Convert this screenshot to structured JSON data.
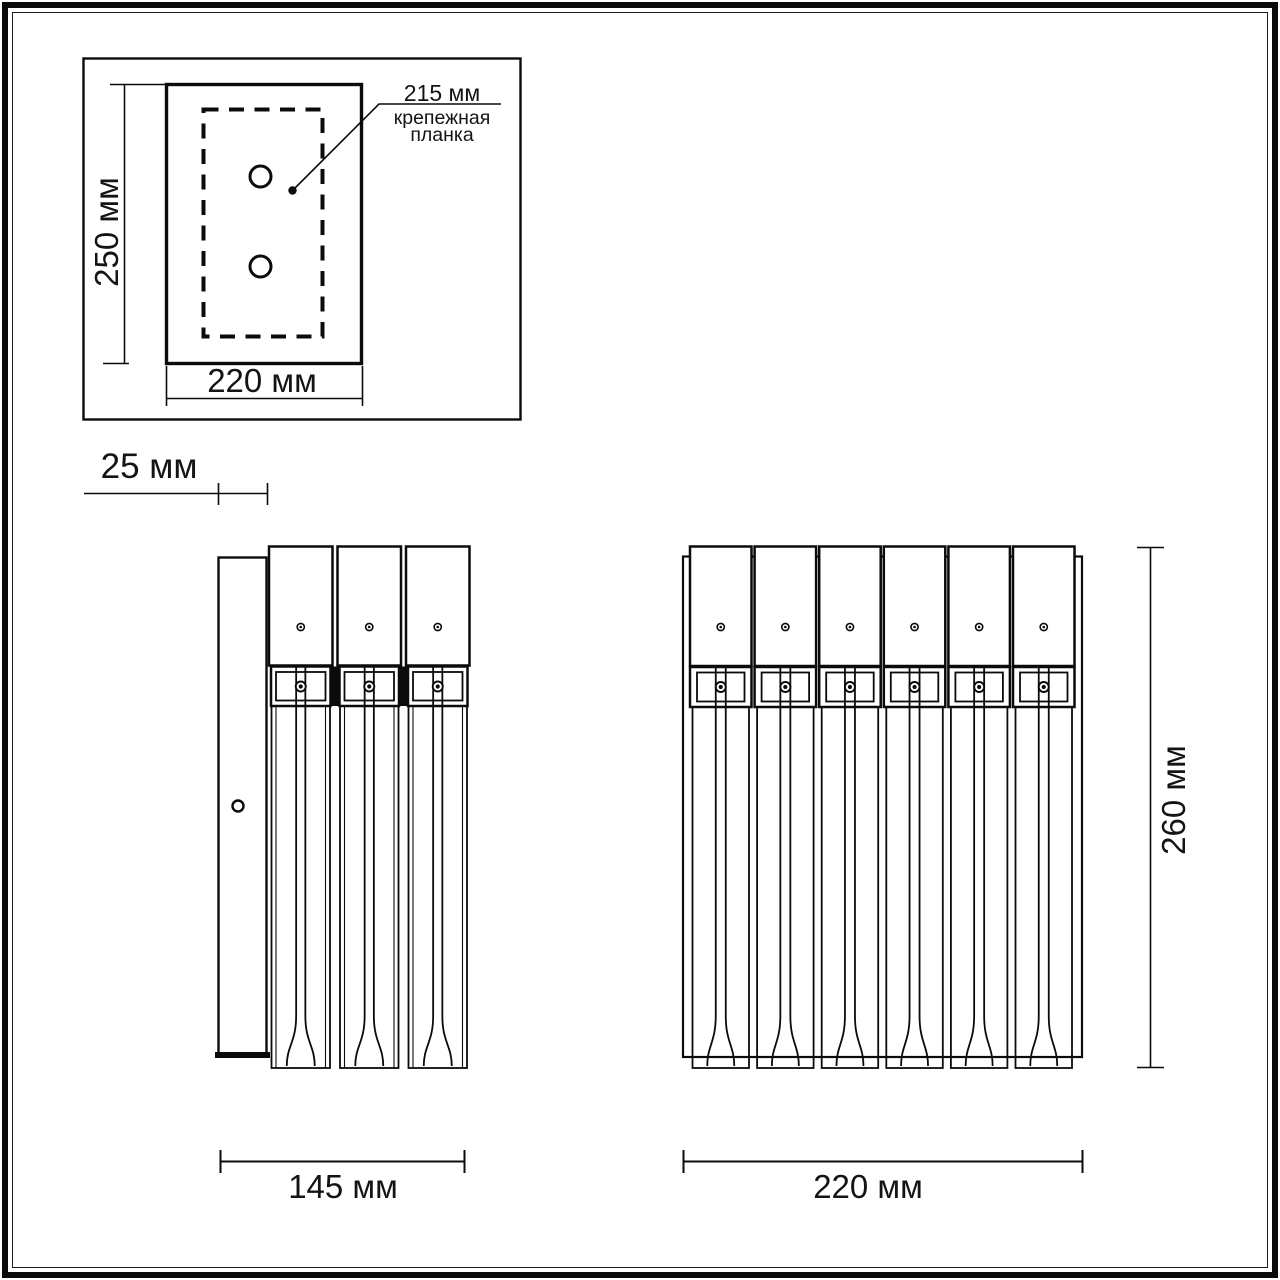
{
  "colors": {
    "line": "#0b0b0b",
    "background": "#ffffff",
    "text": "#141414"
  },
  "top_view": {
    "height_label": "250 мм",
    "width_label": "220 мм",
    "callout": {
      "value": "215 мм",
      "line1": "крепежная",
      "line2": "планка"
    }
  },
  "side_view": {
    "depth_label": "25 мм",
    "width_label": "145 мм",
    "module_count": 3
  },
  "front_view": {
    "width_label": "220 мм",
    "height_label": "260 мм",
    "module_count": 6
  }
}
